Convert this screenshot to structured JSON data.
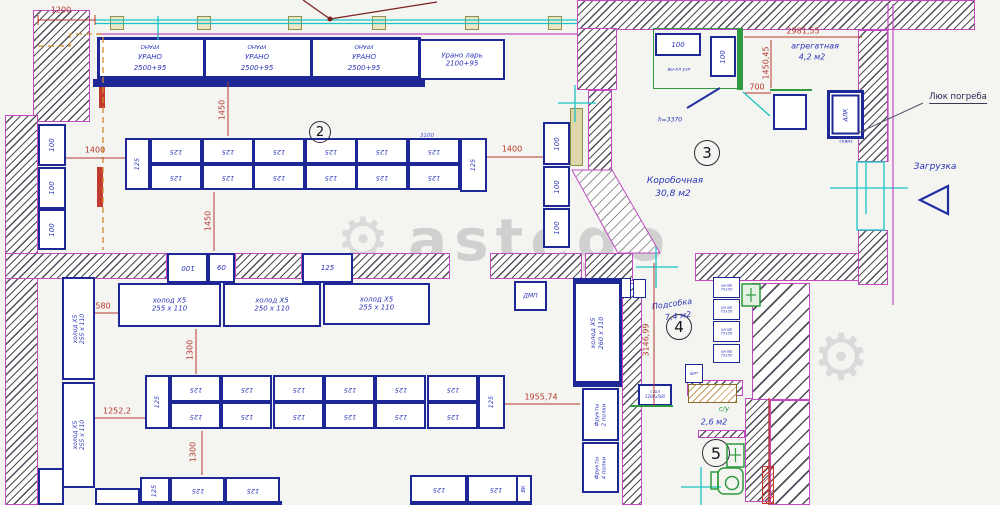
{
  "watermark": {
    "text": "astego",
    "gear": "⚙"
  },
  "rooms": {
    "room2_number": "2",
    "room3_number": "3",
    "room3_name": "Коробочная",
    "room3_area": "30,8 м2",
    "room4_number": "4",
    "room4_name": "Подсобка",
    "room4_area": "7,4 м2",
    "room5_number": "5",
    "room5_name": "с/у",
    "room5_area": "2,6 м2",
    "agg_name": "агрегатная",
    "agg_area": "4,2 м2"
  },
  "labels": {
    "urano": "УРАНО",
    "u_size": "2500+95",
    "lar1": "Урано ларь",
    "lar2": "2100+95",
    "n100": "100",
    "n60": "60",
    "n125": "125",
    "vk": "ВК",
    "dmp": "ДМП",
    "holod": "холод Х5",
    "s255": "255 x 110",
    "s250": "250 x 110",
    "s255v": "255 х 110",
    "s260": "260 х 110",
    "fruit": "Фрукты",
    "p2": "2 полки",
    "p4": "4 полки",
    "cab1": "шкаф",
    "cab2": "75х50",
    "shield": "щит",
    "table1": "стол",
    "table2": "1200х500",
    "alk": "АЛК"
  },
  "callouts": {
    "h": "h=3370",
    "note": "вы-кл узл",
    "alk_sub": "сквиз",
    "lyuk": "Люк погреба",
    "loading": "Загрузка",
    "approx": "3100"
  },
  "dims": {
    "d1200": "1200",
    "d1400": "1400",
    "d1450": "1450",
    "d580": "580",
    "d1300": "1300",
    "d1252": "1252,2",
    "d1955": "1955,74",
    "d3146": "3146,99",
    "d2981": "2981,55",
    "d1450_45": "1450,45",
    "d700": "700"
  }
}
